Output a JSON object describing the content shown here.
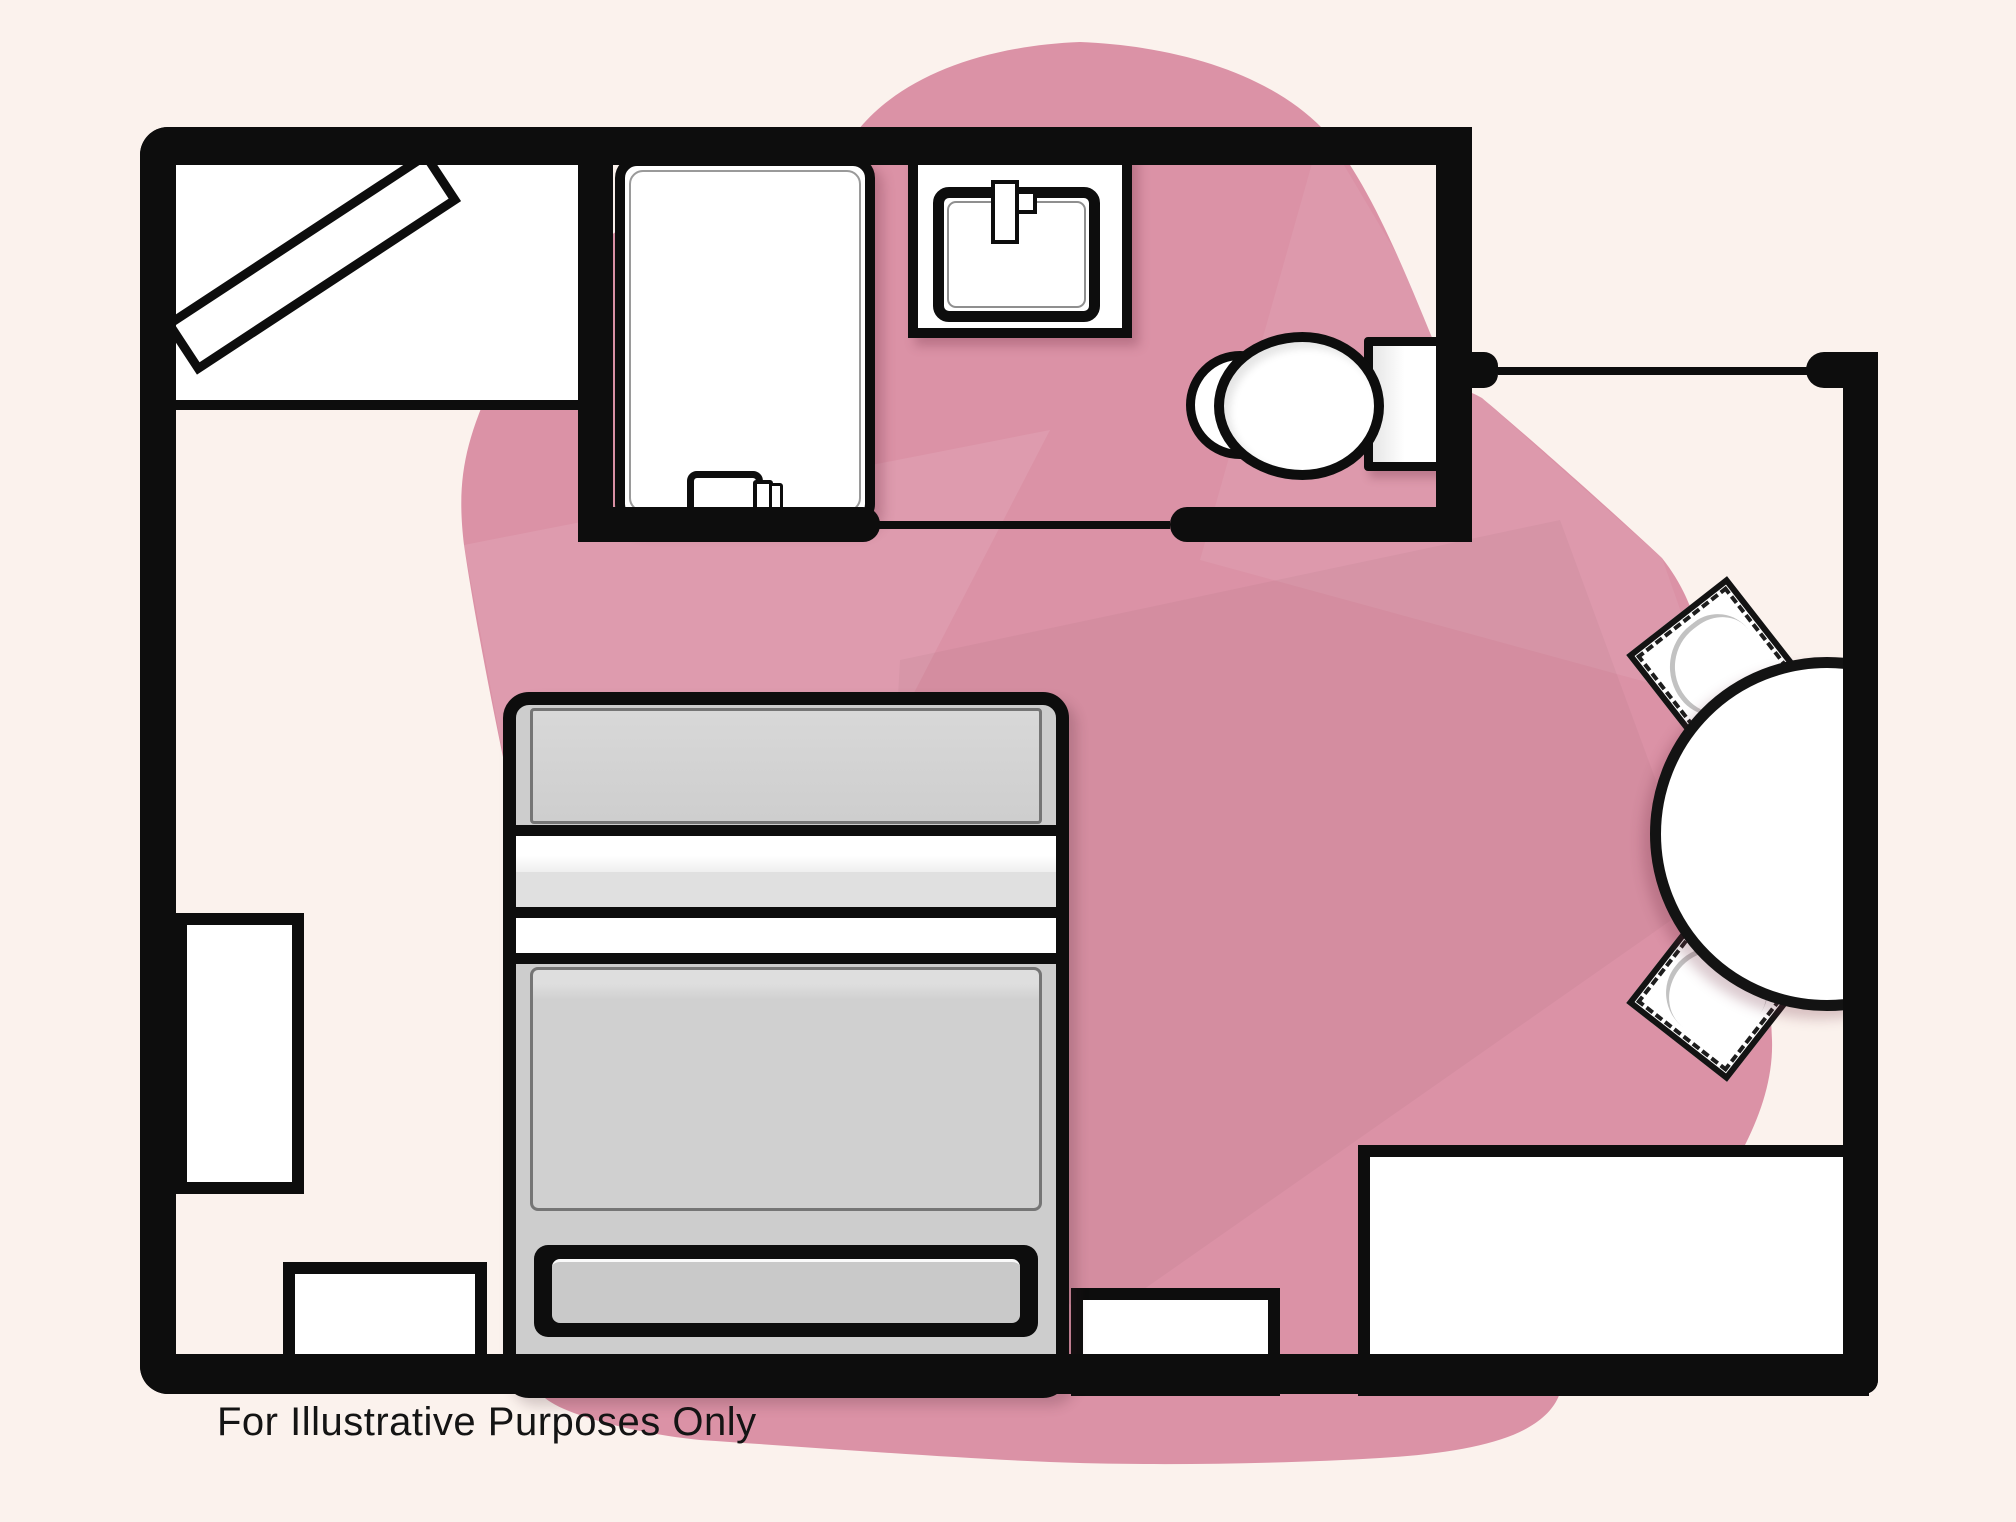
{
  "page": {
    "type": "floor-plan-illustration",
    "disclaimer": "For Illustrative Purposes Only"
  },
  "colors": {
    "background": "#FBF2ED",
    "blob_pink": "#DB92A6",
    "blob_facet_light": "rgba(255,255,255,0.09)",
    "blob_facet_dark": "rgba(0,0,0,0.03)",
    "wall_black": "#0D0D0D",
    "furniture_white": "#FFFFFF",
    "bed_gray": "#CDCDCD",
    "bed_panel_gray": "#D2D2D2",
    "bed_band_gray": "#E0E0E0",
    "text_ink": "#141414"
  },
  "rooms": [
    {
      "name": "closet",
      "floor": "white"
    },
    {
      "name": "bathroom",
      "floor": "open"
    },
    {
      "name": "main-room",
      "floor": "open"
    }
  ],
  "fixtures": [
    {
      "name": "closet-door-panel",
      "shape": "rotated-rectangle"
    },
    {
      "name": "shower-stall",
      "shape": "rounded-rectangle"
    },
    {
      "name": "shower-door-handle",
      "shape": "small-rounded-rectangle"
    },
    {
      "name": "sink-counter",
      "shape": "rectangle"
    },
    {
      "name": "sink-basin",
      "shape": "rounded-rectangle"
    },
    {
      "name": "faucet",
      "shape": "small-bar"
    },
    {
      "name": "toilet-bowl",
      "shape": "ellipse"
    },
    {
      "name": "toilet-tank",
      "shape": "rectangle"
    },
    {
      "name": "bed",
      "shape": "rounded-rectangle-with-bands"
    },
    {
      "name": "left-cabinet",
      "shape": "rectangle"
    },
    {
      "name": "bench-left",
      "shape": "rectangle"
    },
    {
      "name": "bench-right",
      "shape": "rectangle"
    },
    {
      "name": "dresser",
      "shape": "rectangle"
    },
    {
      "name": "dining-table",
      "shape": "circle"
    },
    {
      "name": "chair-top",
      "shape": "rotated-square-fringed"
    },
    {
      "name": "chair-bottom",
      "shape": "rotated-square-fringed"
    }
  ]
}
